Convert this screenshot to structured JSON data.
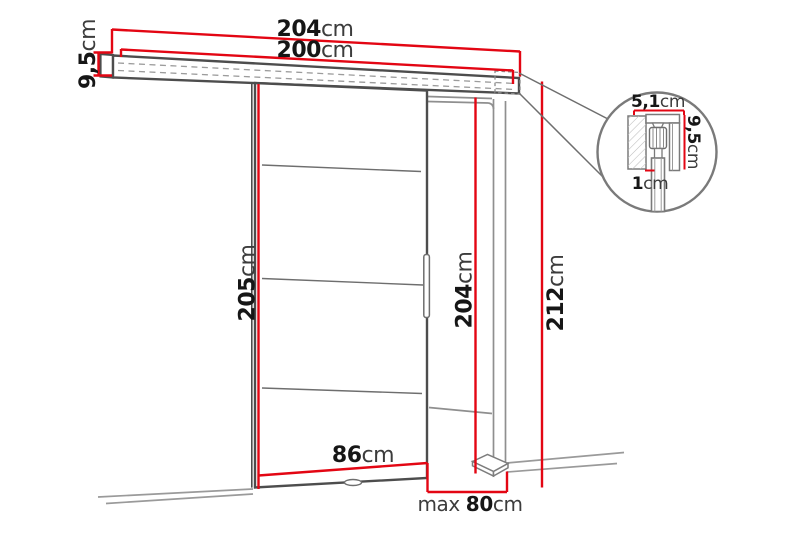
{
  "diagram": {
    "kind": "sliding-door-dimension-diagram",
    "unit": "cm"
  },
  "dimensions": {
    "rail_outer_width": {
      "value": "204",
      "unit": "cm"
    },
    "rail_inner_width": {
      "value": "200",
      "unit": "cm"
    },
    "rail_height": {
      "value": "9,5",
      "unit": "cm"
    },
    "door_height": {
      "value": "205",
      "unit": "cm"
    },
    "door_width": {
      "value": "86",
      "unit": "cm"
    },
    "opening_height": {
      "value": "204",
      "unit": "cm"
    },
    "total_height": {
      "value": "212",
      "unit": "cm"
    },
    "opening_width": {
      "prefix": "max ",
      "value": "80",
      "unit": "cm"
    },
    "detail_track_width": {
      "value": "5,1",
      "unit": "cm"
    },
    "detail_track_height": {
      "value": "9,5",
      "unit": "cm"
    },
    "detail_gap": {
      "value": "1",
      "unit": "cm"
    }
  },
  "colors": {
    "dimension_red": "#e30613",
    "outline_gray": "#4d4d4d",
    "light_gray": "#8f8f8f"
  }
}
